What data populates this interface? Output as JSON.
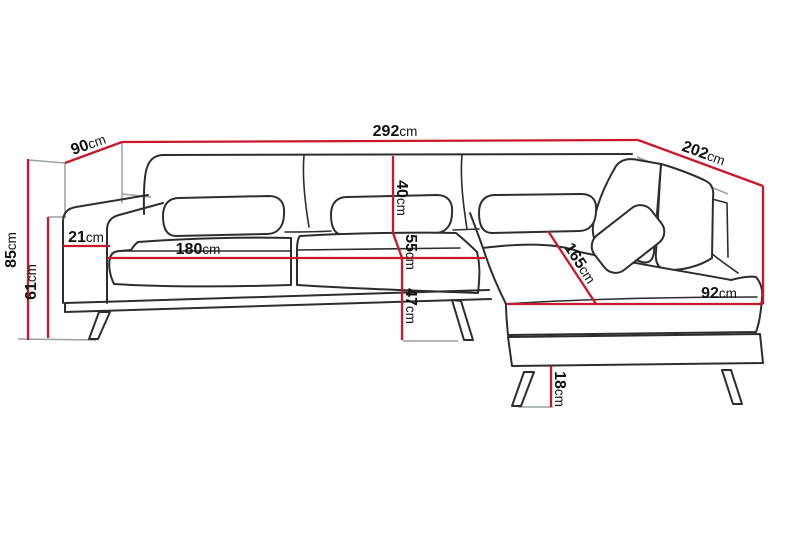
{
  "diagram": {
    "subject": "corner-sofa-dimension-drawing",
    "unit": "cm",
    "accent_color": "#c9182b",
    "outline_color": "#2d2d2d",
    "helper_line_color": "#9aa0a3",
    "label_color": "#101010"
  },
  "dimensions": [
    {
      "name": "total-width",
      "value": "292",
      "unit": "cm"
    },
    {
      "name": "left-depth",
      "value": "90",
      "unit": "cm"
    },
    {
      "name": "right-depth",
      "value": "202",
      "unit": "cm"
    },
    {
      "name": "overall-height",
      "value": "85",
      "unit": "cm"
    },
    {
      "name": "armrest-height",
      "value": "61",
      "unit": "cm"
    },
    {
      "name": "armrest-width",
      "value": "21",
      "unit": "cm"
    },
    {
      "name": "seat-width",
      "value": "180",
      "unit": "cm"
    },
    {
      "name": "backrest-height",
      "value": "40",
      "unit": "cm"
    },
    {
      "name": "seat-depth",
      "value": "55",
      "unit": "cm"
    },
    {
      "name": "seat-height",
      "value": "47",
      "unit": "cm"
    },
    {
      "name": "chaise-length",
      "value": "165",
      "unit": "cm"
    },
    {
      "name": "chaise-width",
      "value": "92",
      "unit": "cm"
    },
    {
      "name": "leg-height",
      "value": "18",
      "unit": "cm"
    }
  ]
}
